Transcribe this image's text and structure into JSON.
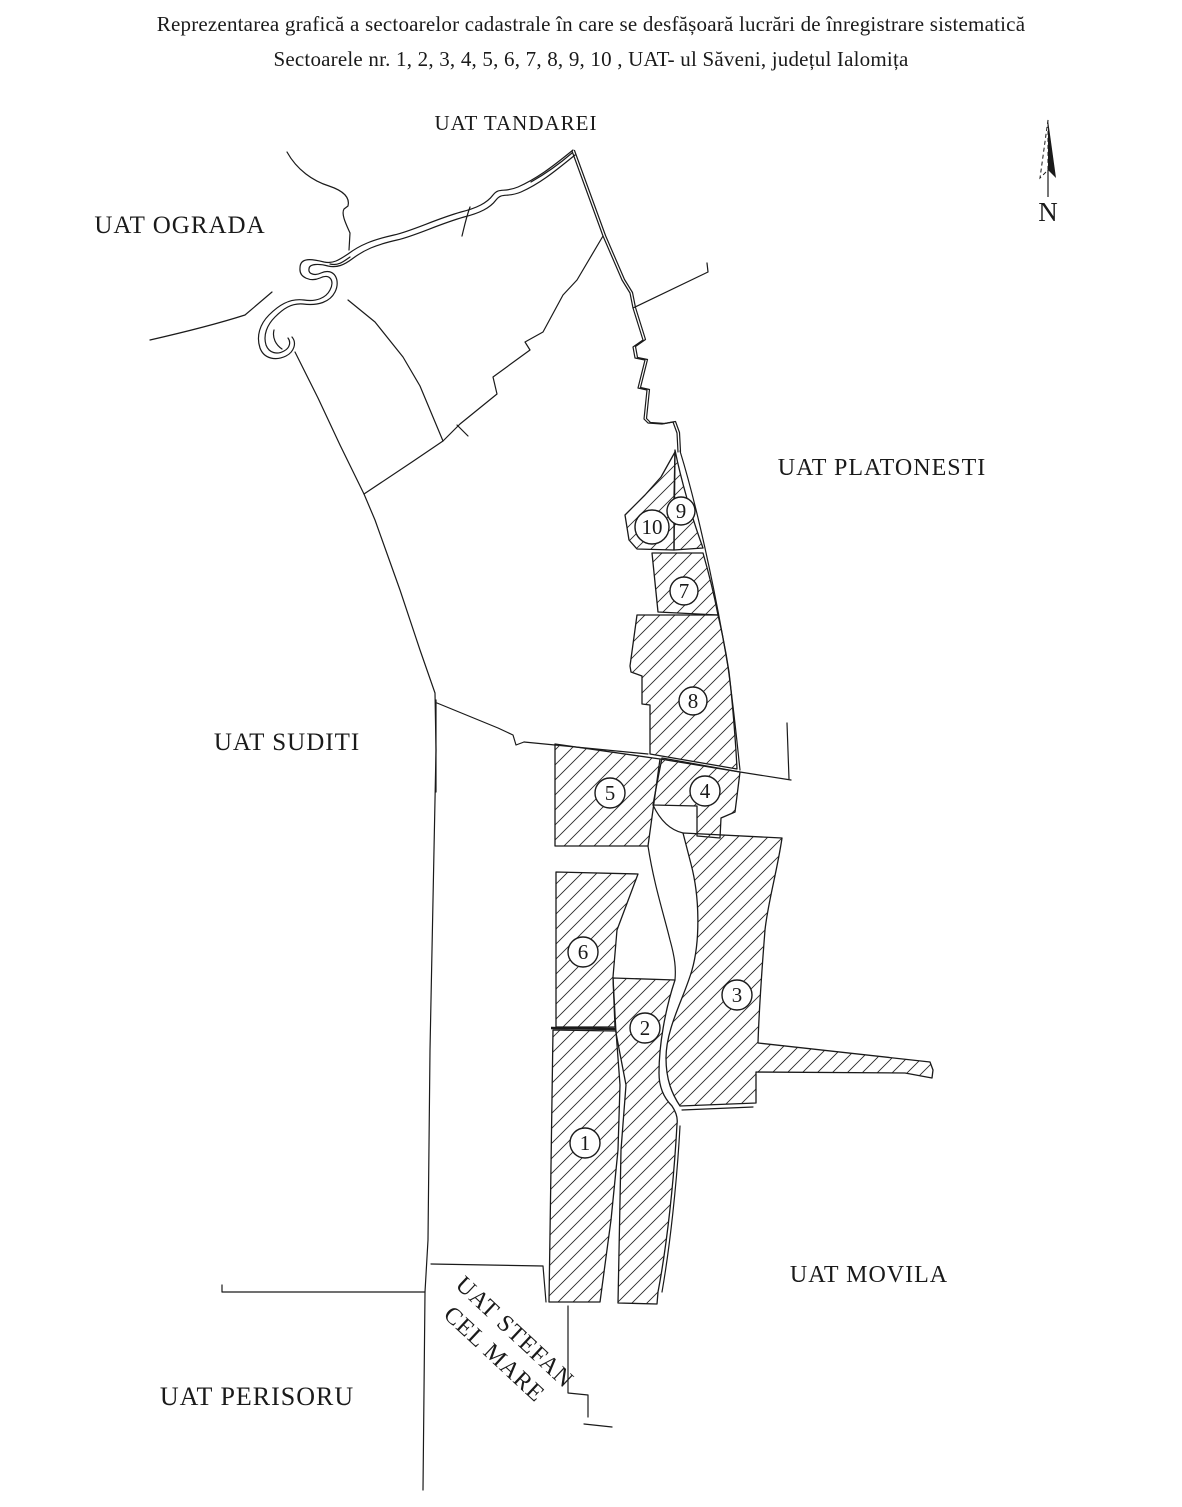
{
  "title": {
    "line1": "Reprezentarea grafică a sectoarelor cadastrale în care se desfășoară lucrări de înregistrare sistematică",
    "line2": "Sectoarele nr. 1, 2, 3, 4, 5, 6, 7, 8, 9, 10 , UAT- ul Săveni, județul Ialomița"
  },
  "map": {
    "north_label": "N",
    "neighbors": {
      "tandarei": "UAT TANDAREI",
      "ograda": "UAT OGRADA",
      "platonesti": "UAT PLATONESTI",
      "suditi": "UAT SUDITI",
      "movila": "UAT MOVILA",
      "perisoru": "UAT PERISORU",
      "stefan_line1": "UAT STEFAN",
      "stefan_line2": "CEL MARE"
    },
    "sectors": [
      {
        "number": "1"
      },
      {
        "number": "2"
      },
      {
        "number": "3"
      },
      {
        "number": "4"
      },
      {
        "number": "5"
      },
      {
        "number": "6"
      },
      {
        "number": "7"
      },
      {
        "number": "8"
      },
      {
        "number": "9"
      },
      {
        "number": "10"
      }
    ]
  },
  "colors": {
    "ink": "#1a1a1a",
    "background": "#ffffff"
  }
}
